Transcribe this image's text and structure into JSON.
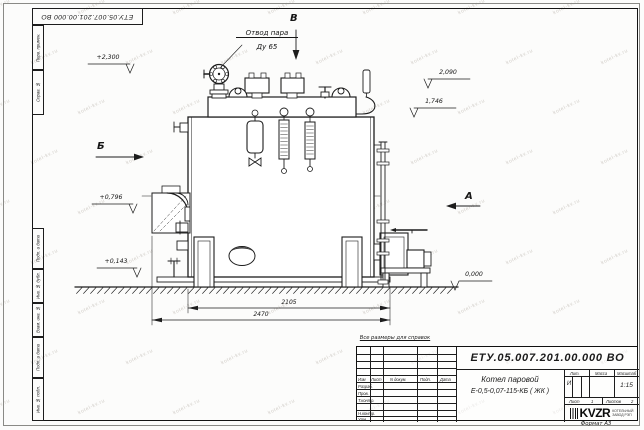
{
  "watermark": {
    "text": "kotel-kv.ru"
  },
  "frame": {
    "top_stamp": "ЕТУ.05.007.201.00.000 ВО",
    "margin_labels": {
      "perv_primen": "Перв. примен.",
      "sprav_no": "Справ. №",
      "podp_data": "Подп. и дата",
      "inv_dubl": "Инв. № дубл.",
      "vzam_inv": "Взам. инв. №",
      "inv_podl": "Инв. № подл.",
      "format": "Формат А3"
    }
  },
  "annotations": {
    "note": "Все размеры для справок",
    "steam_outlet_line1": "Отвод пара",
    "steam_outlet_line2": "Ду 65",
    "view_b": "Б",
    "view_v": "В",
    "view_a": "А",
    "elev_top_left": "+2,300",
    "elev_right_1": "2,090",
    "elev_right_2": "1,746",
    "elev_left_1": "+0,796",
    "elev_left_2": "+0,143",
    "elev_ground": "0,000"
  },
  "dimensions": {
    "upper": "2105",
    "lower": "2470"
  },
  "title_block": {
    "doc_number": "ЕТУ.05.007.201.00.000  ВО",
    "product_line1": "Котел паровой",
    "product_line2": "Е-0,5-0,07-115-КБ ( ЖК )",
    "cols": {
      "izm": "Изм",
      "list": "Лист",
      "ndoc": "N докум.",
      "podp": "Подп.",
      "data": "Дата"
    },
    "rows": {
      "razrab": "Разраб.",
      "prov": "Пров.",
      "tkontr": "Т.контр.",
      "nkontr": "Н.контр.",
      "utv": "Утв."
    },
    "lit_header": "Лит.",
    "mass_header": "Масса",
    "scale_header": "Масштаб",
    "lit_value": "И",
    "scale_value": "1:15",
    "sheet_word": "Лист",
    "sheet_num": "1",
    "sheets_word": "Листов",
    "sheets_num": "2",
    "company_logo": "KVZR",
    "company_line1": "КОТЕЛЬНЫЙ",
    "company_line2": "ЗАВОД РЭП"
  }
}
